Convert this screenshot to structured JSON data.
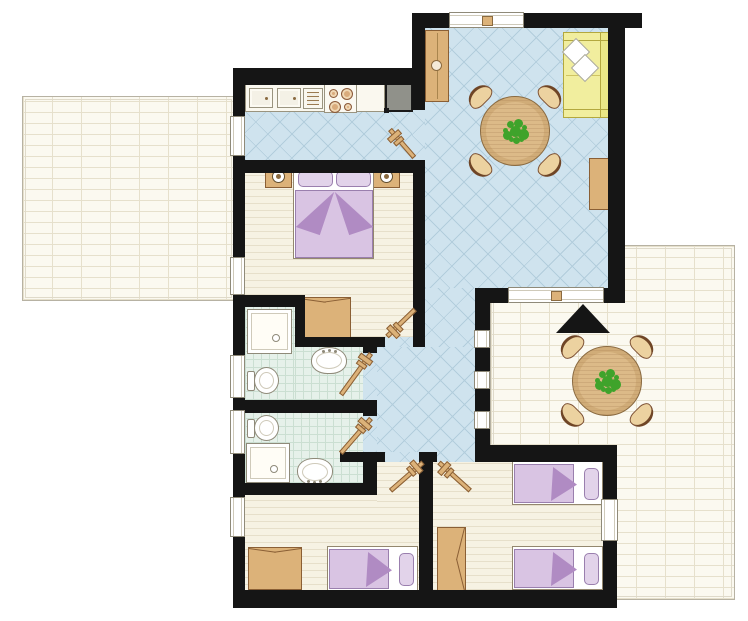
{
  "title": "apartment-floor-plan",
  "canvas": {
    "width": 748,
    "height": 621
  },
  "colors": {
    "wall": "#151515",
    "tile": "#cfe3ee",
    "tile-line": "#b2cddc",
    "bath": "#e6f1ea",
    "bath-line": "#cbdfd2",
    "wood": "#f6f2e3",
    "wood-line": "#e6dfca",
    "brick": "#fbf9f0",
    "brick-line": "#e6e0cc",
    "tan": "#dcb279",
    "tan-dark": "#8a5f35",
    "table": "#dcba88",
    "purple": "#d9c4e3",
    "purple-dark": "#b08bc3",
    "yellow": "#f1ee9e",
    "appliance": "#90918a",
    "plant": "#3fa32b",
    "fixture": "#fffdf6"
  },
  "rooms": [
    {
      "name": "kitchen",
      "floor": "blue-tile"
    },
    {
      "name": "living-dining-room",
      "floor": "blue-tile"
    },
    {
      "name": "hallway",
      "floor": "blue-tile"
    },
    {
      "name": "master-bedroom",
      "floor": "wood"
    },
    {
      "name": "bathroom-1",
      "floor": "green-tile"
    },
    {
      "name": "bathroom-2",
      "floor": "green-tile"
    },
    {
      "name": "bedroom-2",
      "floor": "wood"
    },
    {
      "name": "bedroom-3",
      "floor": "wood"
    },
    {
      "name": "terrace-left",
      "floor": "brick-paving"
    },
    {
      "name": "terrace-right",
      "floor": "brick-paving"
    }
  ],
  "furniture": {
    "kitchen": [
      "counter",
      "double-sink",
      "drainer",
      "stove-4-burners",
      "fridge"
    ],
    "living_dining": [
      "tall-cabinet",
      "sofa",
      "cushions-x2",
      "round-dining-table",
      "chairs-x4",
      "plant",
      "sideboard"
    ],
    "master_bedroom": [
      "double-bed",
      "nightstand-x2",
      "lamp-x2",
      "wardrobe"
    ],
    "bathroom_1": [
      "shower",
      "toilet",
      "sink"
    ],
    "bathroom_2": [
      "shower",
      "toilet",
      "sink"
    ],
    "bedroom_2": [
      "single-bed",
      "wardrobe"
    ],
    "bedroom_3": [
      "single-bed-x2",
      "wardrobe"
    ],
    "terrace_right": [
      "round-outdoor-table",
      "chairs-x4",
      "plant",
      "canopy-marker"
    ]
  },
  "counts": {
    "windows": 11,
    "interior-doors": 6,
    "terraces": 2,
    "bathrooms": 2,
    "bedrooms": 3
  }
}
